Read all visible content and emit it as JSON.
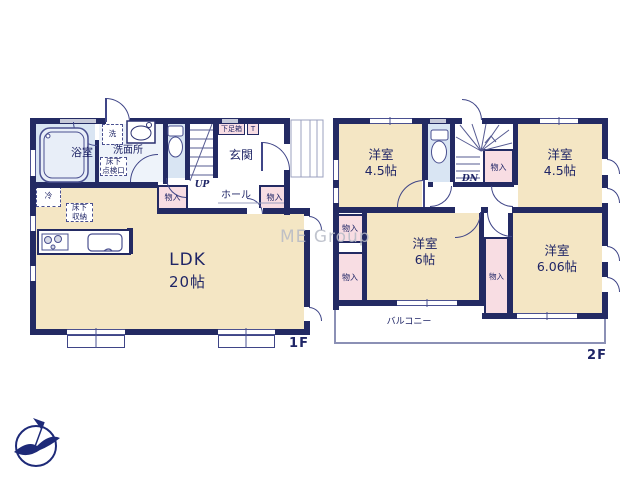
{
  "watermark": "ME Group",
  "floor1": {
    "label": "1F",
    "bath": "浴室",
    "washroom": "洗面所",
    "washing_machine": "洗",
    "hatch_line1": "床下",
    "hatch_line2": "点検口",
    "fridge": "冷",
    "storage_line1": "床下",
    "storage_line2": "収納",
    "entrance": "玄関",
    "shoe_box": "下足箱",
    "shoe_box_t": "T",
    "hall": "ホール",
    "up": "UP",
    "closet_left": "物入",
    "closet_right": "物入",
    "ldk_name": "LDK",
    "ldk_size": "20帖"
  },
  "floor2": {
    "label": "2F",
    "dn": "DN",
    "room_nw_name": "洋室",
    "room_nw_size": "4.5帖",
    "room_ne_name": "洋室",
    "room_ne_size": "4.5帖",
    "room_sw_name": "洋室",
    "room_sw_size": "6帖",
    "room_se_name": "洋室",
    "room_se_size": "6.06帖",
    "closet_center": "物入",
    "closet_west_upper": "物入",
    "closet_west_lower": "物入",
    "closet_mid": "物入",
    "balcony": "バルコニー"
  },
  "colors": {
    "wall": "#232a63",
    "room_cream": "#f4e6c4",
    "closet_pink": "#f8dde3",
    "wet_blue": "#d9e5f3",
    "washroom_tint": "#eef3fa",
    "line": "#3f4587",
    "fixture": "#4a5090",
    "window_gray": "#c6c9d8",
    "balcony_line": "#8b90b5",
    "label_navy": "#1f2566",
    "watermark_gray": "#b6bac6"
  }
}
